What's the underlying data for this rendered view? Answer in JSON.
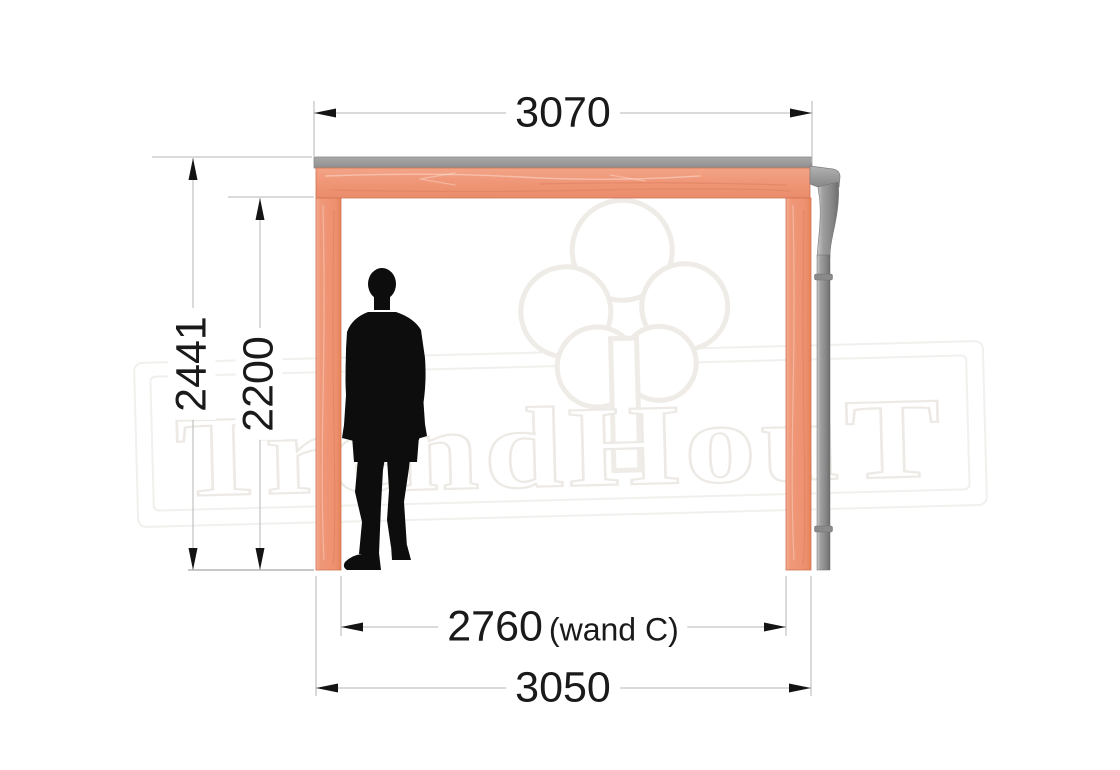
{
  "watermark": {
    "brand": "TrendHouT",
    "logo_icon": "tree-outline-icon",
    "outline_color": "#edeae6"
  },
  "dimensions": {
    "roof_width_top": "3070",
    "overall_height": "2441",
    "clear_height": "2200",
    "inner_width": "2760",
    "inner_width_note": "(wand C)",
    "outer_width_bottom": "3050"
  },
  "colors": {
    "wood": "#ef9677",
    "roof_panel": "#9c9c9c",
    "downpipe": "#8f8f8f",
    "dimension_line": "#b5b5b5",
    "dimension_text": "#1a1a1a",
    "silhouette": "#0d0d0d"
  },
  "figures": {
    "scale_figure": "human-silhouette"
  }
}
